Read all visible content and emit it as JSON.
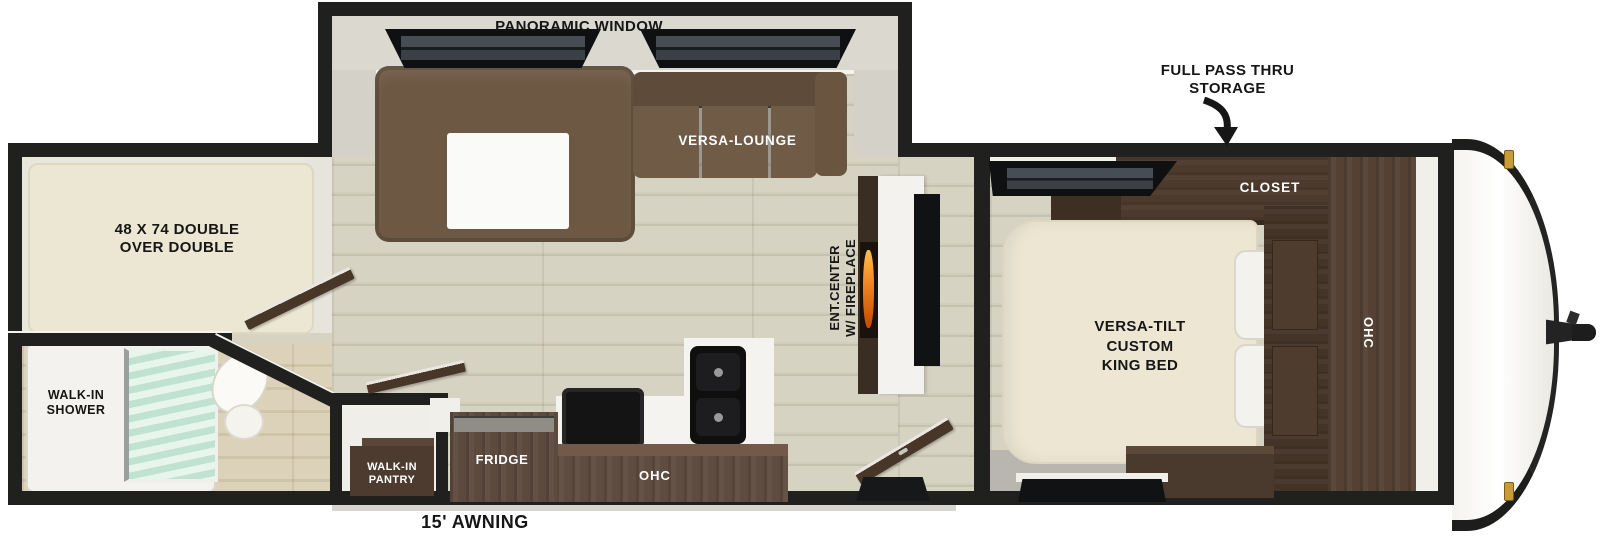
{
  "exterior": {
    "storage_label": "FULL PASS THRU\nSTORAGE",
    "awning_label": "15' AWNING"
  },
  "slideout": {
    "window_label": "PANORAMIC WINDOW",
    "lounge_label": "VERSA-LOUNGE"
  },
  "bunk_room": {
    "bed_label": "48 X 74 DOUBLE\nOVER DOUBLE"
  },
  "bathroom": {
    "shower_label": "WALK-IN\nSHOWER"
  },
  "kitchen": {
    "pantry_label": "WALK-IN\nPANTRY",
    "fridge_label": "FRIDGE",
    "overhead_cabinet_label": "OHC"
  },
  "living_room": {
    "entertainment_label": "ENT.CENTER\nW/ FIREPLACE"
  },
  "bedroom": {
    "closet_label": "CLOSET",
    "bed_label": "VERSA-TILT\nCUSTOM\nKING BED",
    "overhead_cabinet_label": "OHC"
  },
  "colors": {
    "wall_black": "#20211f",
    "floor_wood": "#d5d1c0",
    "sofa_brown": "#6d5843",
    "cabinet_dark_wood": "#4a3a2d",
    "kitchen_wood": "#5f4c40",
    "mattress_cream": "#ece6d2",
    "shower_glass_mint": "#cde9db",
    "flame_orange": "#f08220",
    "marker_light_gold": "#c79b3a"
  }
}
